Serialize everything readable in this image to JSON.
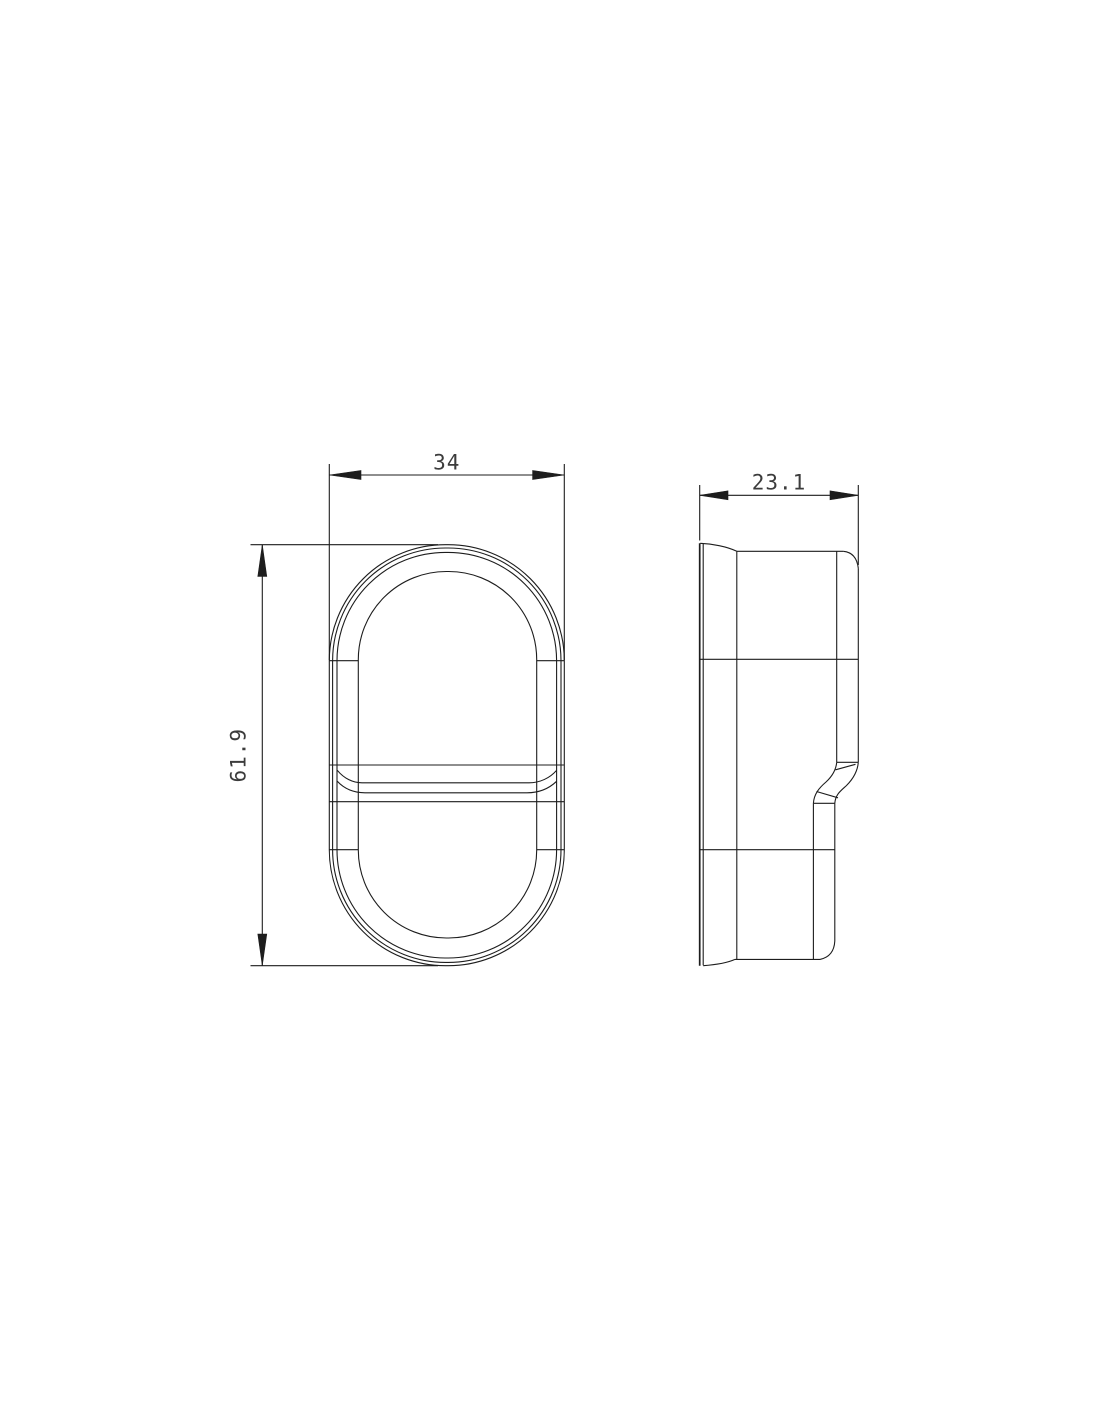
{
  "canvas": {
    "background_color": "#ffffff",
    "line_color": "#1d1d1d",
    "dimension_text_color": "#3c3c3c"
  },
  "drawing": {
    "front_view": {
      "width_dim": {
        "value": "34"
      },
      "height_dim": {
        "value": "61.9"
      }
    },
    "side_view": {
      "depth_dim": {
        "value": "23.1"
      }
    }
  }
}
